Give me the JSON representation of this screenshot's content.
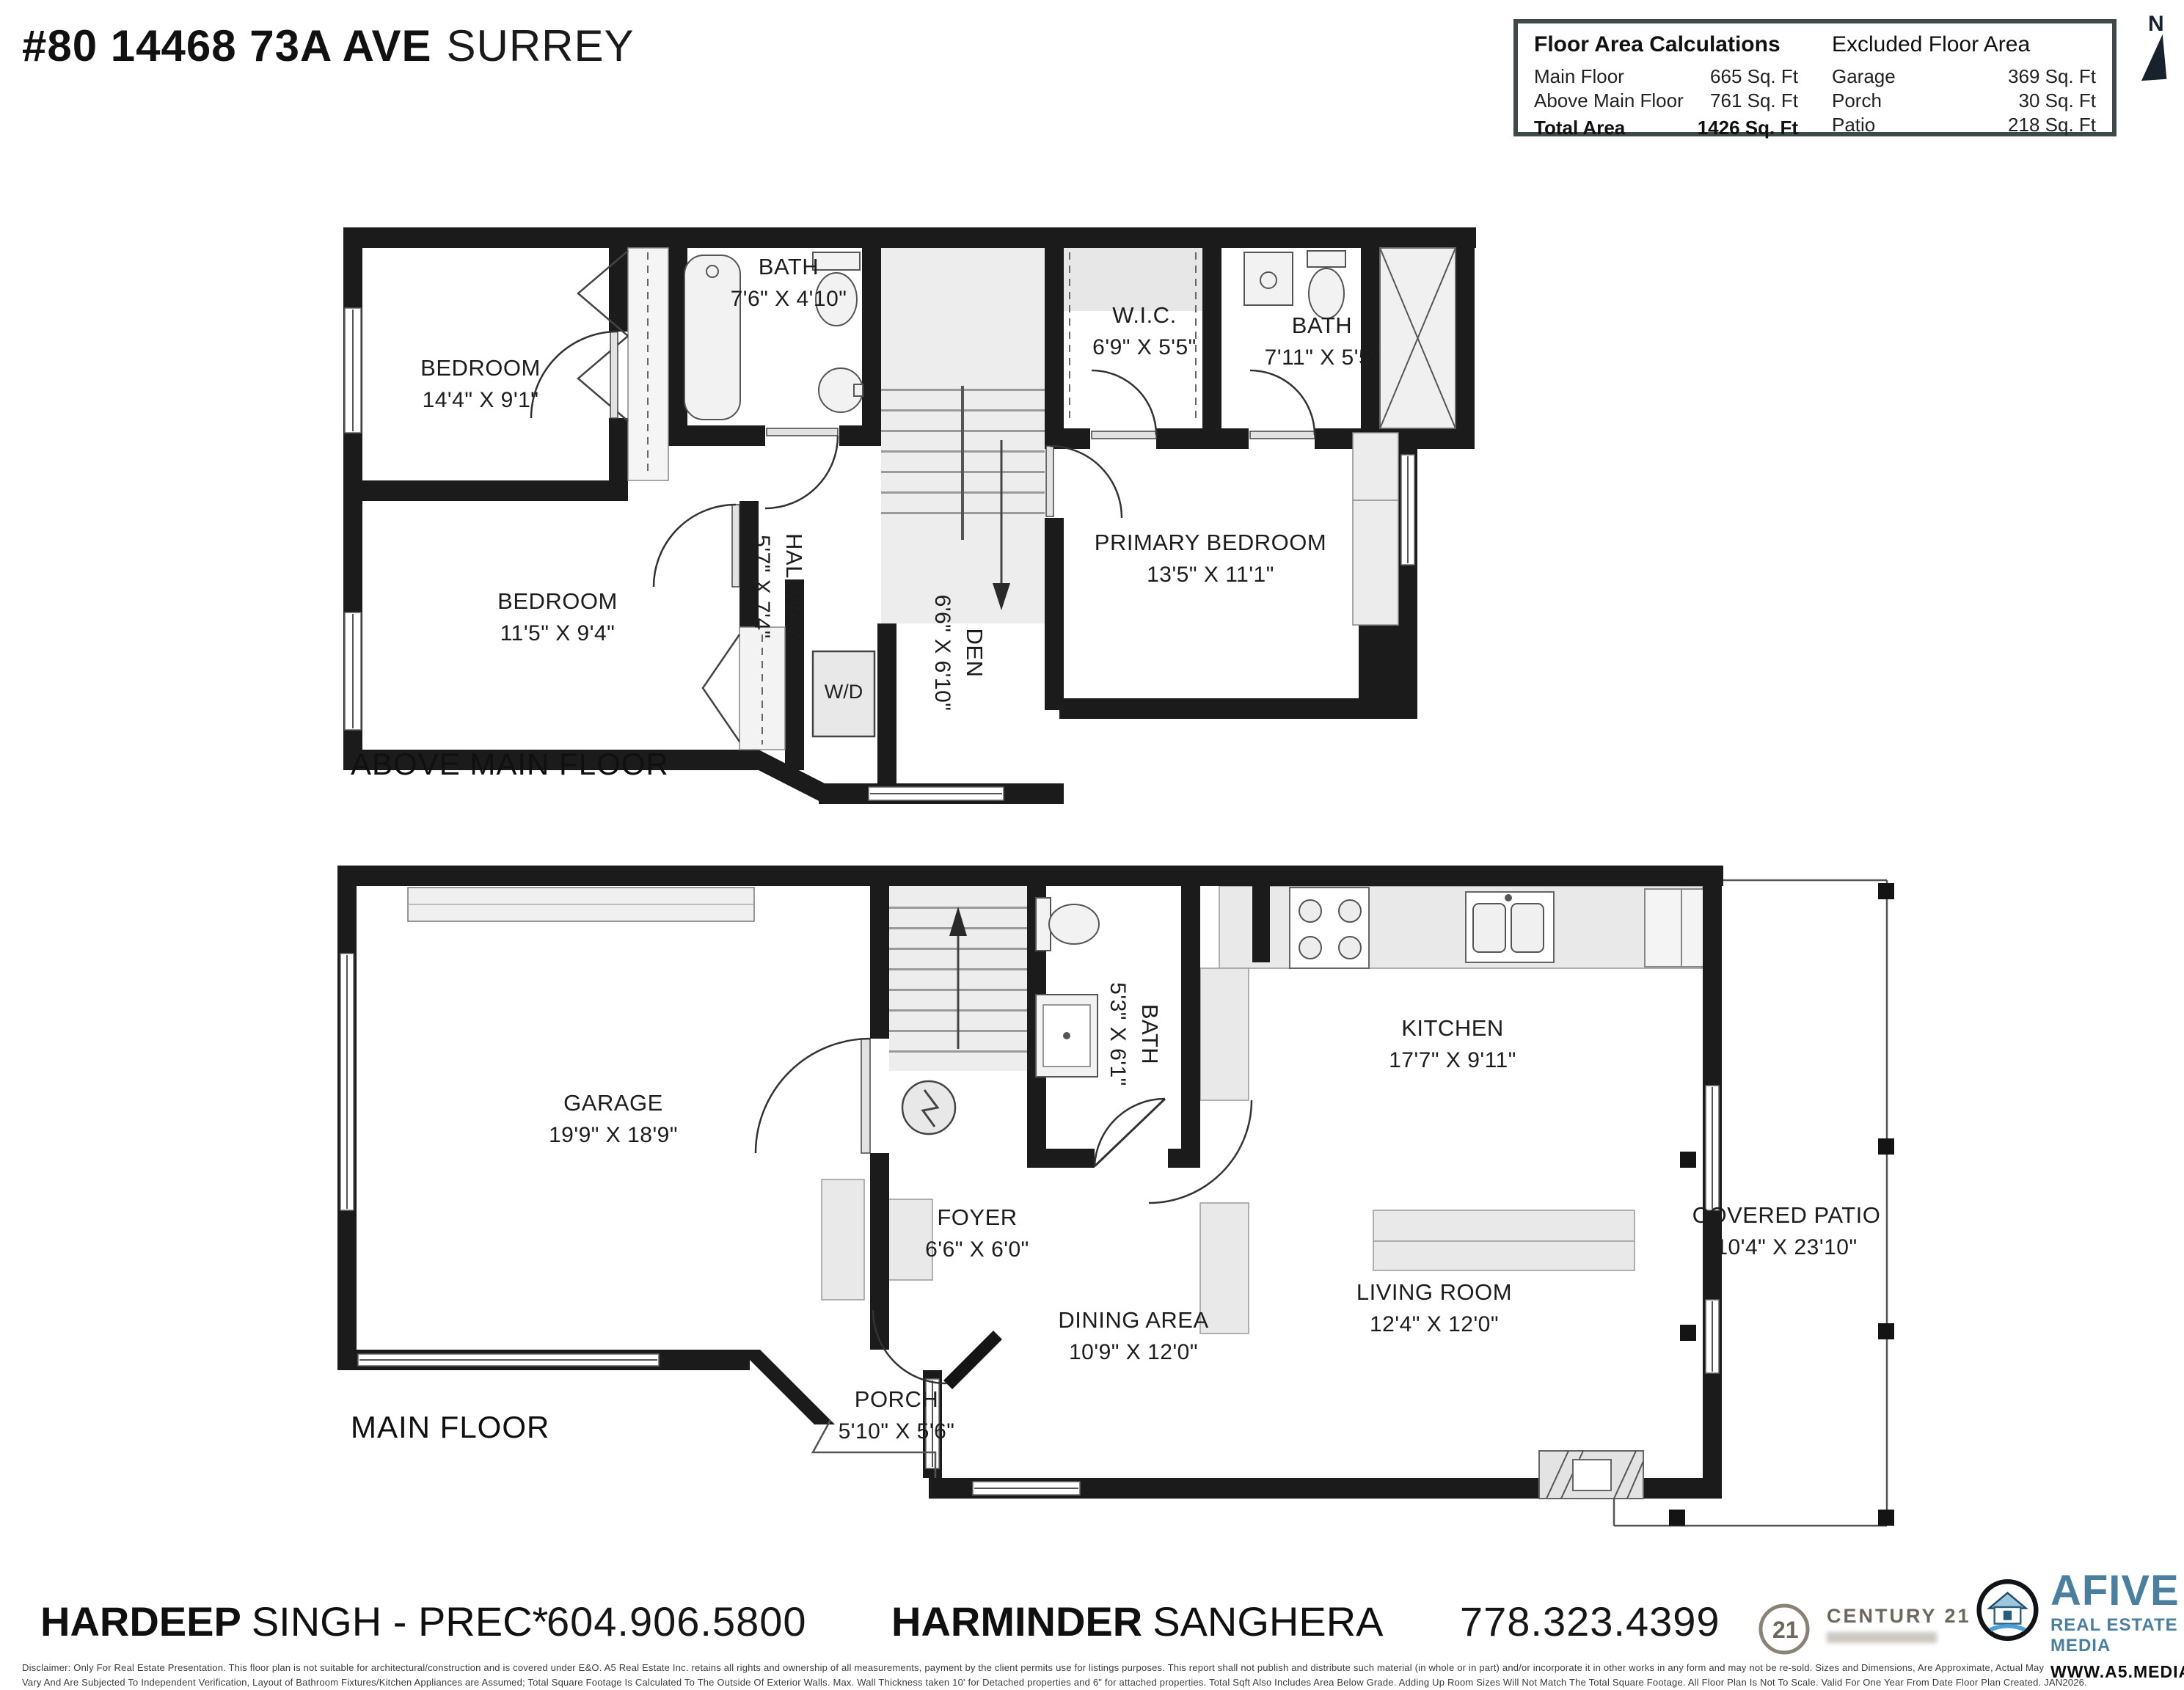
{
  "header": {
    "address_primary": "#80 14468 73A AVE",
    "address_secondary": "SURREY",
    "north_label": "N",
    "floor_area": {
      "title": "Floor Area Calculations",
      "rows": [
        {
          "label": "Main Floor",
          "value": "665 Sq. Ft"
        },
        {
          "label": "Above Main Floor",
          "value": "761 Sq. Ft"
        }
      ],
      "total": {
        "label": "Total Area",
        "value": "1426 Sq. Ft"
      }
    },
    "excluded_area": {
      "title": "Excluded Floor Area",
      "rows": [
        {
          "label": "Garage",
          "value": "369 Sq. Ft"
        },
        {
          "label": "Porch",
          "value": "30 Sq. Ft"
        },
        {
          "label": "Patio",
          "value": "218 Sq. Ft"
        }
      ]
    }
  },
  "floors": [
    {
      "name": "ABOVE MAIN FLOOR",
      "rooms": [
        {
          "label": "BEDROOM",
          "dims": "14'4\" X 9'1\""
        },
        {
          "label": "BATH",
          "dims": "7'6\" X 4'10\""
        },
        {
          "label": "W.I.C.",
          "dims": "6'9\" X 5'5\""
        },
        {
          "label": "BATH",
          "dims": "7'11\" X 5'5\""
        },
        {
          "label": "HALLWAY",
          "dims": "5'7\" X 7'4\""
        },
        {
          "label": "DEN",
          "dims": "6'6\" X 6'10\""
        },
        {
          "label": "PRIMARY BEDROOM",
          "dims": "13'5\" X 11'1\""
        },
        {
          "label": "BEDROOM",
          "dims": "11'5\" X 9'4\""
        },
        {
          "label": "W/D",
          "dims": ""
        }
      ]
    },
    {
      "name": "MAIN FLOOR",
      "rooms": [
        {
          "label": "GARAGE",
          "dims": "19'9\" X 18'9\""
        },
        {
          "label": "BATH",
          "dims": "5'3\" X 6'1\""
        },
        {
          "label": "KITCHEN",
          "dims": "17'7\" X 9'11\""
        },
        {
          "label": "FOYER",
          "dims": "6'6\" X 6'0\""
        },
        {
          "label": "DINING AREA",
          "dims": "10'9\" X 12'0\""
        },
        {
          "label": "LIVING ROOM",
          "dims": "12'4\" X 12'0\""
        },
        {
          "label": "PORCH",
          "dims": "5'10\" X 5'6\""
        },
        {
          "label": "COVERED PATIO",
          "dims": "10'4\" X 23'10\""
        }
      ]
    }
  ],
  "footer": {
    "agent1": {
      "first": "HARDEEP",
      "rest": "SINGH - PREC*",
      "phone": "604.906.5800"
    },
    "agent2": {
      "first": "HARMINDER",
      "rest": "SANGHERA",
      "phone": "778.323.4399"
    },
    "century21": {
      "number": "21",
      "name": "CENTURY 21"
    },
    "afive": {
      "name": "AFIVE",
      "tagline": "REAL ESTATE MEDIA",
      "website": "WWW.A5.MEDIA"
    },
    "disclaimer_line1": "Disclaimer:  Only For Real Estate Presentation. This floor plan is not suitable for architectural/construction and is covered under E&O. A5 Real Estate Inc. retains all rights and ownership of all measurements, payment by the client permits use for listings purposes. This report shall not publish and distribute such material (in whole or in part) and/or incorporate it in other works in any form and may not be re-sold. Sizes and Dimensions, Are Approximate, Actual May",
    "disclaimer_line2": "Vary And Are Subjected To Independent Verification, Layout of Bathroom Fixtures/Kitchen Appliances are Assumed; Total Square Footage Is Calculated To The Outside Of Exterior Walls. Max. Wall Thickness taken 10' for Detached properties and 6\" for attached properties. Total Sqft Also Includes Area Below Grade. Adding Up Room Sizes Will Not Match The Total Square Footage. All Floor Plan Is Not To Scale. Valid For One Year From Date Floor Plan Created. JAN2026."
  }
}
